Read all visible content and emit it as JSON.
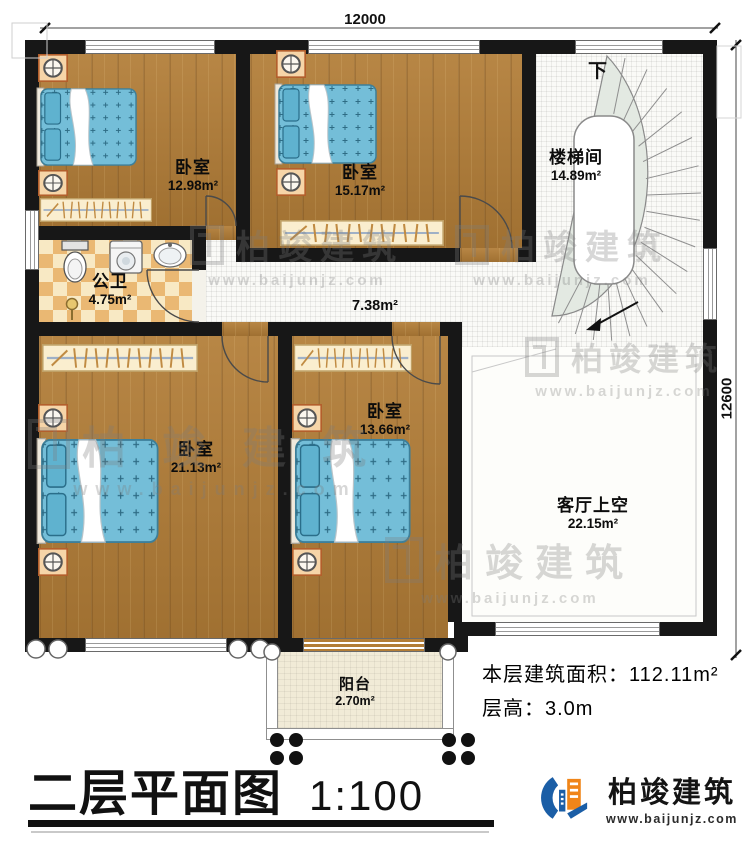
{
  "dimensions": {
    "top": "12000",
    "right": "12600"
  },
  "rooms": {
    "bedroom_tl": {
      "name": "卧室",
      "area": "12.98m²"
    },
    "bedroom_tm": {
      "name": "卧室",
      "area": "15.17m²"
    },
    "stairwell": {
      "name": "楼梯间",
      "area": "14.89m²",
      "direction": "下"
    },
    "bathroom": {
      "name": "公卫",
      "area": "4.75m²"
    },
    "corridor": {
      "area": "7.38m²"
    },
    "bedroom_bl": {
      "name": "卧室",
      "area": "21.13m²"
    },
    "bedroom_bm": {
      "name": "卧室",
      "area": "13.66m²"
    },
    "living_void": {
      "name": "客厅上空",
      "area": "22.15m²"
    },
    "balcony": {
      "name": "阳台",
      "area": "2.70m²"
    }
  },
  "annotations": {
    "floor_area_label": "本层建筑面积：",
    "floor_area_value": "112.11m²",
    "floor_height_label": "层高：",
    "floor_height_value": "3.0m"
  },
  "title": {
    "text": "二层平面图",
    "scale": "1:100"
  },
  "branding": {
    "company": "柏竣建筑",
    "website": "www.baijunjz.com"
  },
  "colors": {
    "wall": "#171717",
    "wood_floor": "#b27d37",
    "bed_blue": "#74bed8",
    "tile_orange": "#eab873",
    "stair_tread": "#e3e9e2",
    "accent_blue": "#1b5ea6",
    "accent_orange": "#f08519"
  }
}
